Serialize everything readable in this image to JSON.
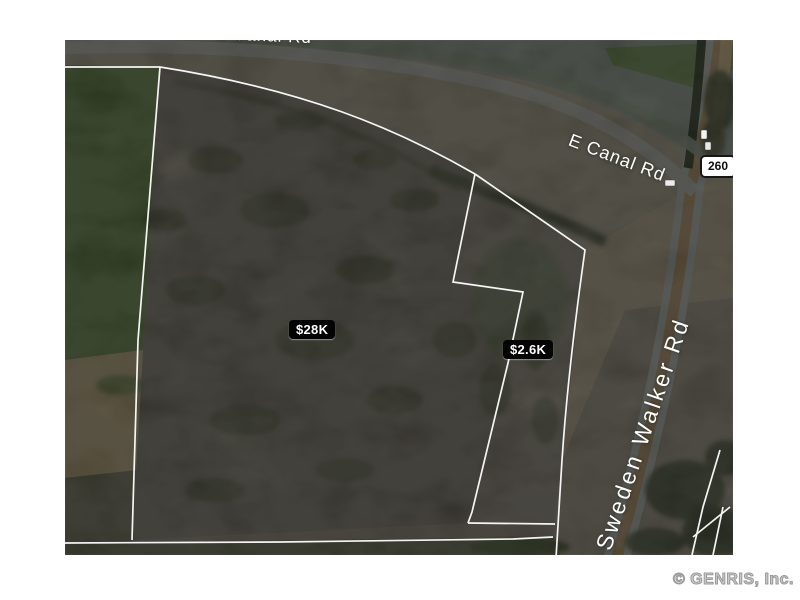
{
  "map": {
    "price_labels": [
      {
        "id": "parcel-main",
        "text": "$28K"
      },
      {
        "id": "parcel-secondary",
        "text": "$2.6K"
      }
    ],
    "route_shield": "260",
    "road_labels": {
      "canal": "E Canal Rd",
      "canal_top_partial": "E Canal Rd",
      "sweden_walker": "Sweden Walker Rd"
    }
  },
  "footer": {
    "copyright": "© GENRIS, Inc."
  },
  "colors": {
    "page_background": "#ffffff",
    "price_label_bg": "#040404",
    "price_label_text": "#ffffff",
    "route_shield_bg": "#ffffff",
    "route_shield_border": "#161616",
    "route_shield_text": "#0e0e0e",
    "road_label_text": "#ffffff",
    "parcel_boundary_line": "#ffffff",
    "copyright_text": "#9a9a9a",
    "terrain_parcel": "#6b675a",
    "terrain_field_green": "#567238",
    "terrain_road_gray": "#9a9a94",
    "terrain_shoulder_tan": "#b39a6c"
  }
}
